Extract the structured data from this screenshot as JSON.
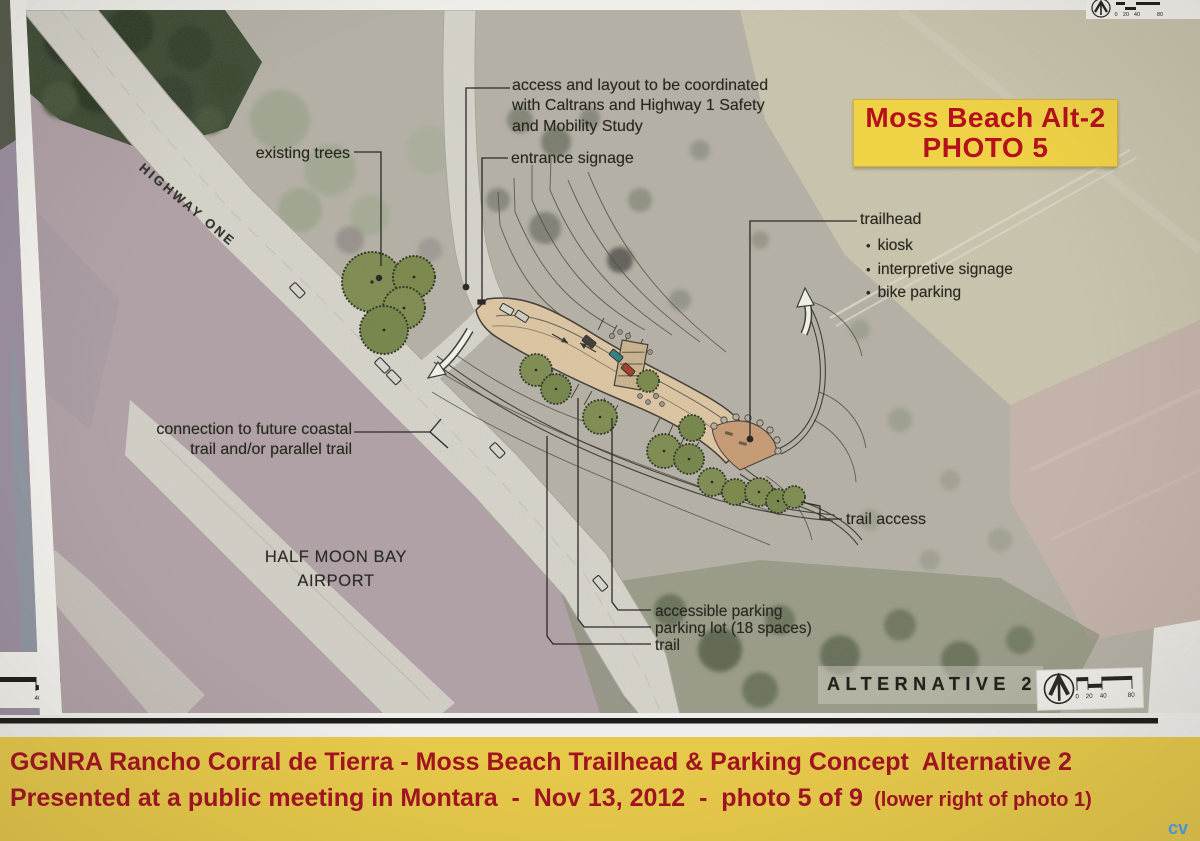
{
  "photo_label": {
    "line1": "Moss Beach Alt-2",
    "line2": "PHOTO 5"
  },
  "map": {
    "highway_label": "HIGHWAY ONE",
    "airport_label": {
      "line1": "HALF MOON BAY",
      "line2": "AIRPORT"
    },
    "alternative_label": "ALTERNATIVE 2",
    "annotations": {
      "access_note": {
        "lines": [
          "access and layout to be coordinated",
          "with Caltrans and Highway 1 Safety",
          "and Mobility Study"
        ]
      },
      "entrance_signage": "entrance signage",
      "existing_trees": "existing trees",
      "trailhead": {
        "title": "trailhead",
        "items": [
          "kiosk",
          "interpretive signage",
          "bike parking"
        ]
      },
      "connection": {
        "lines": [
          "connection to future coastal",
          "trail and/or parallel trail"
        ]
      },
      "trail_access": "trail access",
      "accessible_parking": "accessible parking",
      "parking_lot": "parking lot (18 spaces)",
      "trail": "trail"
    },
    "scale_bar": {
      "labels": [
        "0",
        "20",
        "40",
        "80"
      ]
    }
  },
  "caption": {
    "line1": "GGNRA Rancho Corral de Tierra - Moss Beach Trailhead & Parking Concept  Alternative 2",
    "line2": "Presented at a public meeting in Montara  -  Nov 13, 2012  -  photo 5 of 9",
    "line2_note": "  (lower right of photo 1)",
    "credit": "cv"
  },
  "colors": {
    "caption_bg": "#e7c94a",
    "caption_text": "#a31220",
    "label_box_bg": "#f0d246",
    "label_box_text": "#b5101c",
    "credit_blue": "#4aa0f4",
    "ink": "#28281f"
  }
}
